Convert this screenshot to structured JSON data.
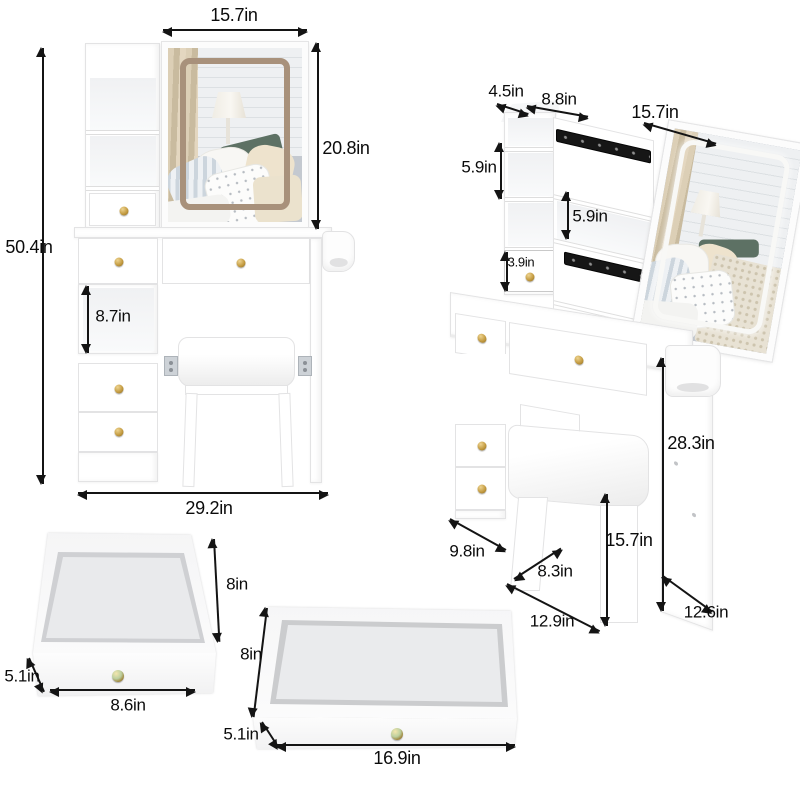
{
  "image_type": "product dimensions diagram",
  "product": "vanity desk set with sliding mirror, hutch drawers and stool",
  "front_view": {
    "mirror_width": "15.7in",
    "mirror_height": "20.8in",
    "overall_height": "50.4in",
    "shelf_opening_height": "8.7in",
    "overall_width": "29.2in"
  },
  "angle_view": {
    "top_depth": "4.5in",
    "hutch_width": "8.8in",
    "sliding_mirror_width": "15.7in",
    "left_shelf_height": "5.9in",
    "middle_shelf_height": "5.9in",
    "small_drawer_height": "3.9in",
    "table_height": "28.3in",
    "stool_height": "15.7in",
    "side_depth": "9.8in",
    "knee_room_width": "8.3in",
    "stool_seat_width": "12.9in",
    "table_depth": "12.6in"
  },
  "square_drawer": {
    "depth": "8in",
    "front_height": "5.1in",
    "width": "8.6in"
  },
  "wide_drawer": {
    "depth": "8in",
    "front_height": "5.1in",
    "width": "16.9in"
  },
  "colors": {
    "knob_gold": "#c49c42",
    "led_frame_tan": "#a8917b",
    "slide_rail_black": "#161616",
    "accent_pillow_green": "#5d7164"
  }
}
